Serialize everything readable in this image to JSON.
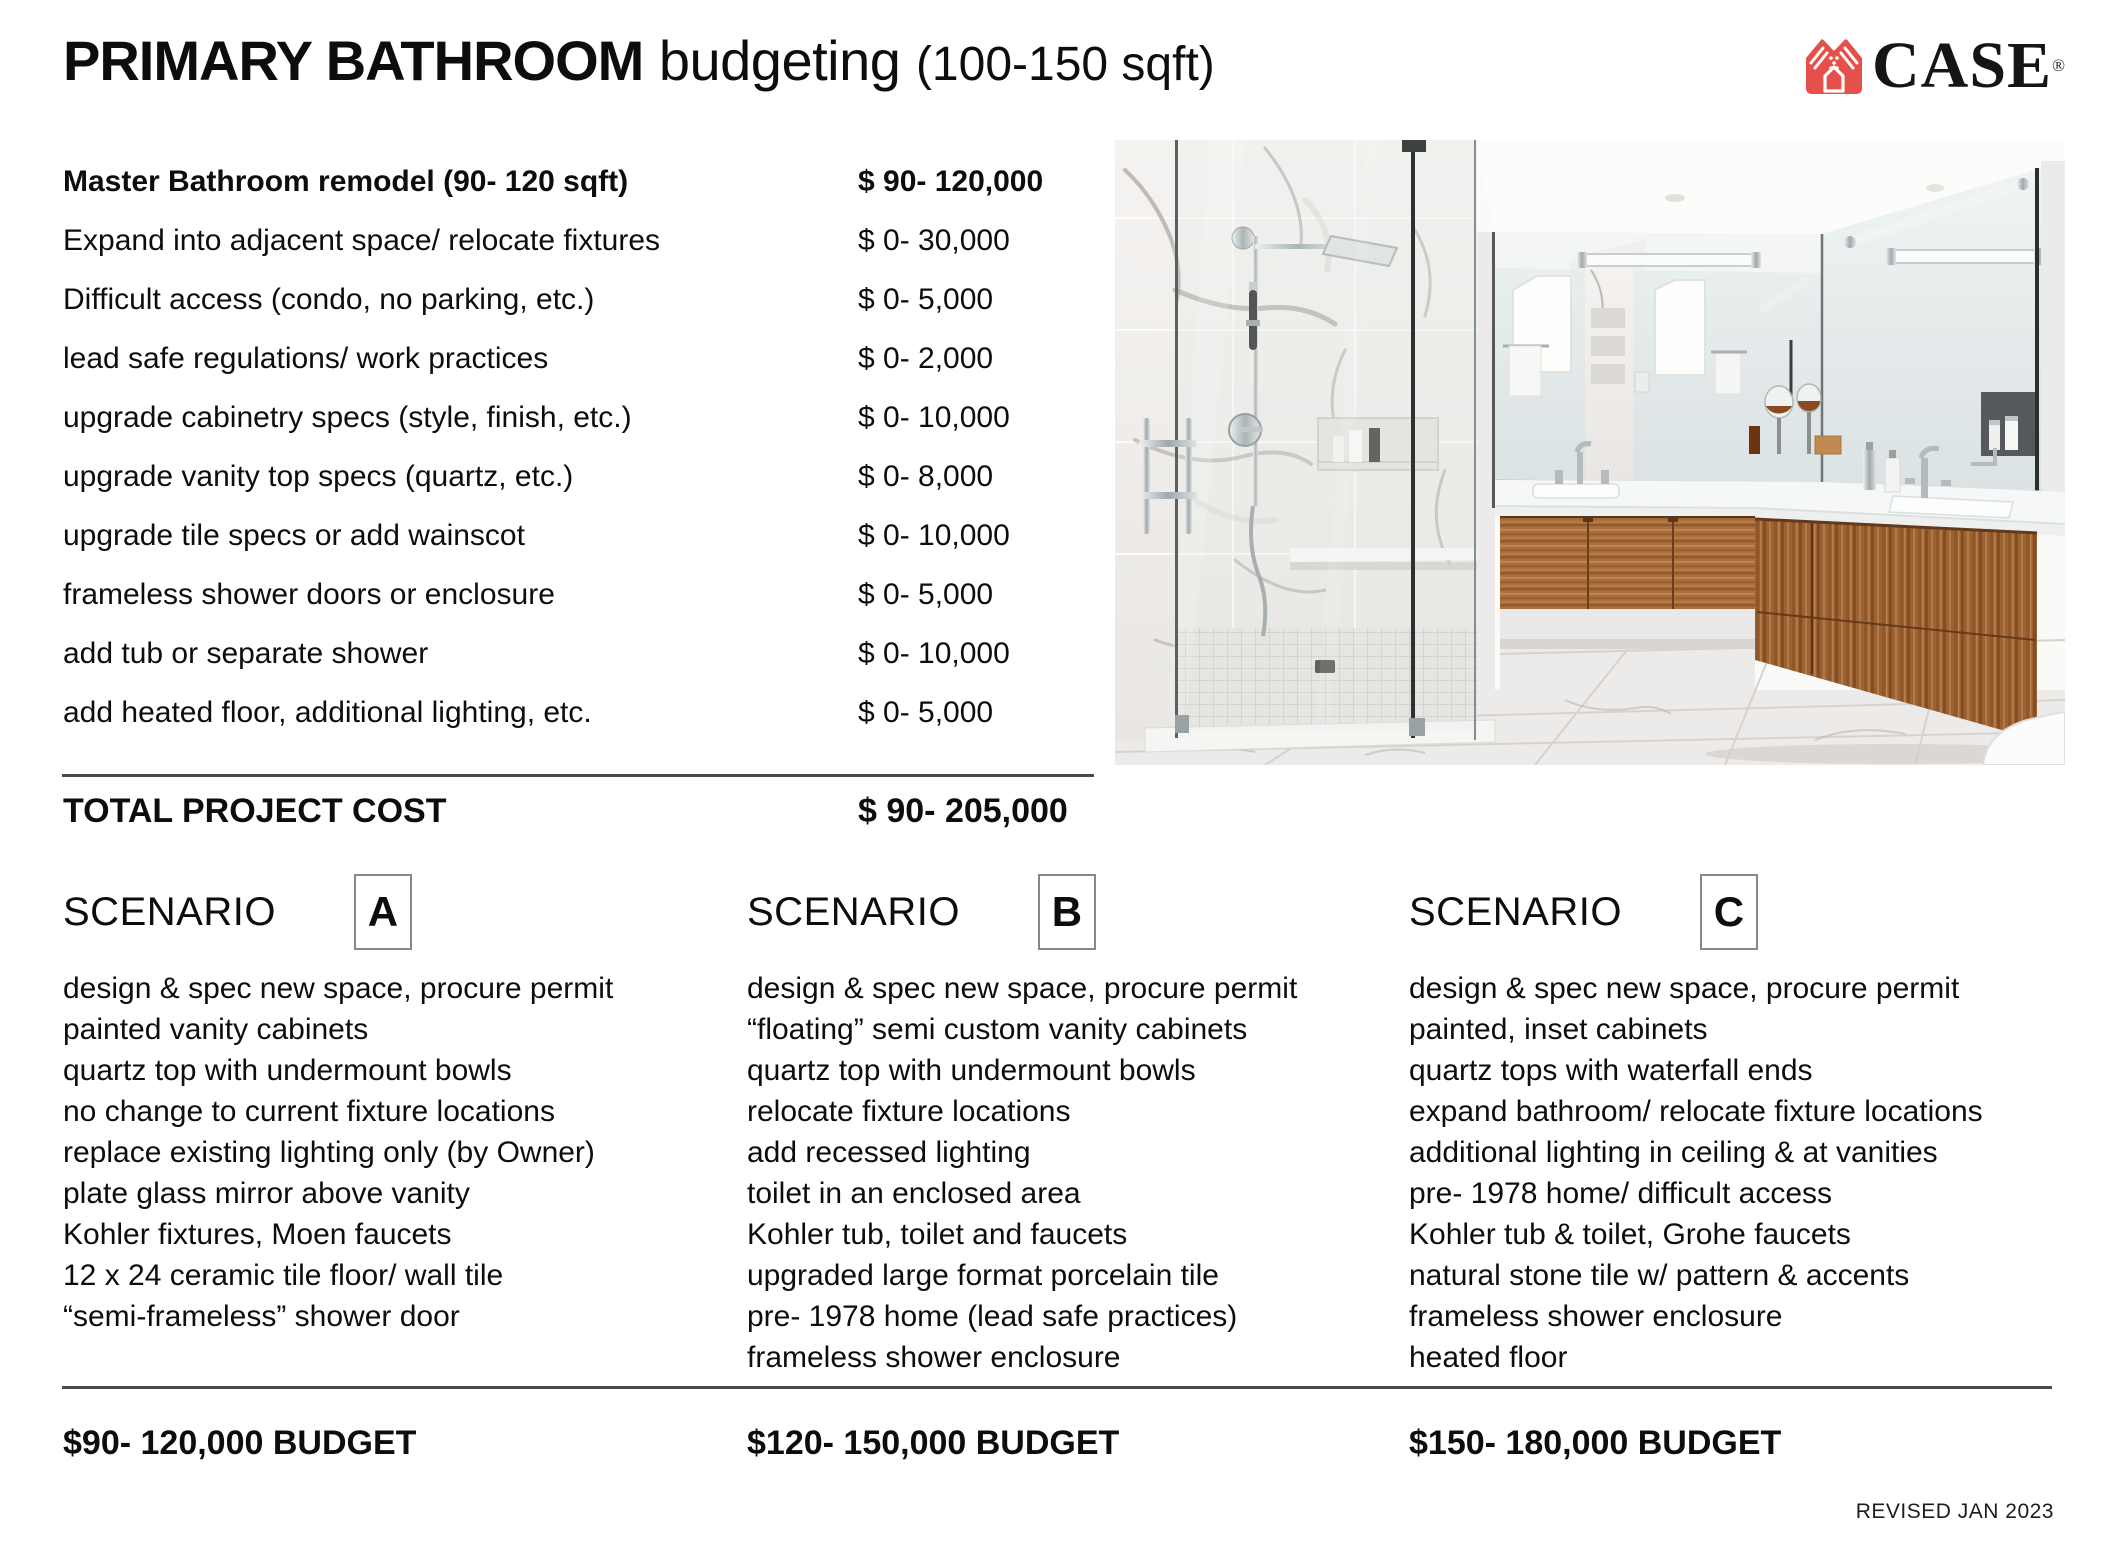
{
  "header": {
    "title_bold": "PRIMARY BATHROOM",
    "title_light": "budgeting",
    "title_size": "(100-150 sqft)",
    "logo_text": "CASE",
    "logo_reg": "®"
  },
  "brand": {
    "logo_color": "#e6504a"
  },
  "cost_table": {
    "rows": [
      {
        "label": "Master Bathroom remodel (90- 120 sqft)",
        "price": "$ 90- 120,000"
      },
      {
        "label": "Expand into adjacent space/ relocate fixtures",
        "price": "$ 0- 30,000"
      },
      {
        "label": "Difficult access (condo, no parking, etc.)",
        "price": "$ 0- 5,000"
      },
      {
        "label": "lead safe regulations/ work practices",
        "price": "$ 0- 2,000"
      },
      {
        "label": "upgrade cabinetry specs (style, finish, etc.)",
        "price": "$ 0- 10,000"
      },
      {
        "label": "upgrade vanity top specs (quartz, etc.)",
        "price": "$ 0- 8,000"
      },
      {
        "label": "upgrade tile specs or add wainscot",
        "price": "$ 0- 10,000"
      },
      {
        "label": "frameless shower doors or enclosure",
        "price": "$ 0- 5,000"
      },
      {
        "label": "add tub or separate shower",
        "price": "$ 0- 10,000"
      },
      {
        "label": "add heated floor, additional lighting, etc.",
        "price": "$ 0- 5,000"
      }
    ],
    "total_label": "TOTAL PROJECT COST",
    "total_price": "$ 90- 205,000"
  },
  "scenarios": [
    {
      "label": "SCENARIO",
      "letter": "A",
      "items": [
        "design & spec new space, procure permit",
        "painted vanity cabinets",
        "quartz top with undermount bowls",
        "no change to current fixture locations",
        "replace existing lighting only (by Owner)",
        "plate glass mirror above vanity",
        "Kohler fixtures, Moen faucets",
        "12 x 24 ceramic tile floor/ wall tile",
        "“semi-frameless” shower door"
      ],
      "budget": "$90- 120,000 BUDGET"
    },
    {
      "label": "SCENARIO",
      "letter": "B",
      "items": [
        "design & spec new space, procure permit",
        "“floating” semi custom vanity cabinets",
        "quartz top with undermount bowls",
        "relocate fixture locations",
        "add recessed lighting",
        "toilet in an enclosed area",
        "Kohler tub, toilet and faucets",
        "upgraded large format porcelain tile",
        "pre- 1978 home (lead safe practices)",
        "frameless shower enclosure"
      ],
      "budget": "$120- 150,000 BUDGET"
    },
    {
      "label": "SCENARIO",
      "letter": "C",
      "items": [
        "design & spec new space, procure permit",
        "painted, inset cabinets",
        "quartz tops with waterfall ends",
        "expand bathroom/ relocate fixture locations",
        "additional lighting in ceiling & at vanities",
        "pre- 1978 home/ difficult access",
        "Kohler tub & toilet, Grohe faucets",
        "natural stone tile w/ pattern & accents",
        "frameless shower enclosure",
        "heated floor"
      ],
      "budget": "$150- 180,000 BUDGET"
    }
  ],
  "photo": {
    "description": "Modern primary bathroom: glass walk-in marble shower, floating walnut L-shaped double vanity with white quartz top, mirror wall, marble tile floor"
  },
  "footer": {
    "revised": "REVISED JAN 2023"
  }
}
